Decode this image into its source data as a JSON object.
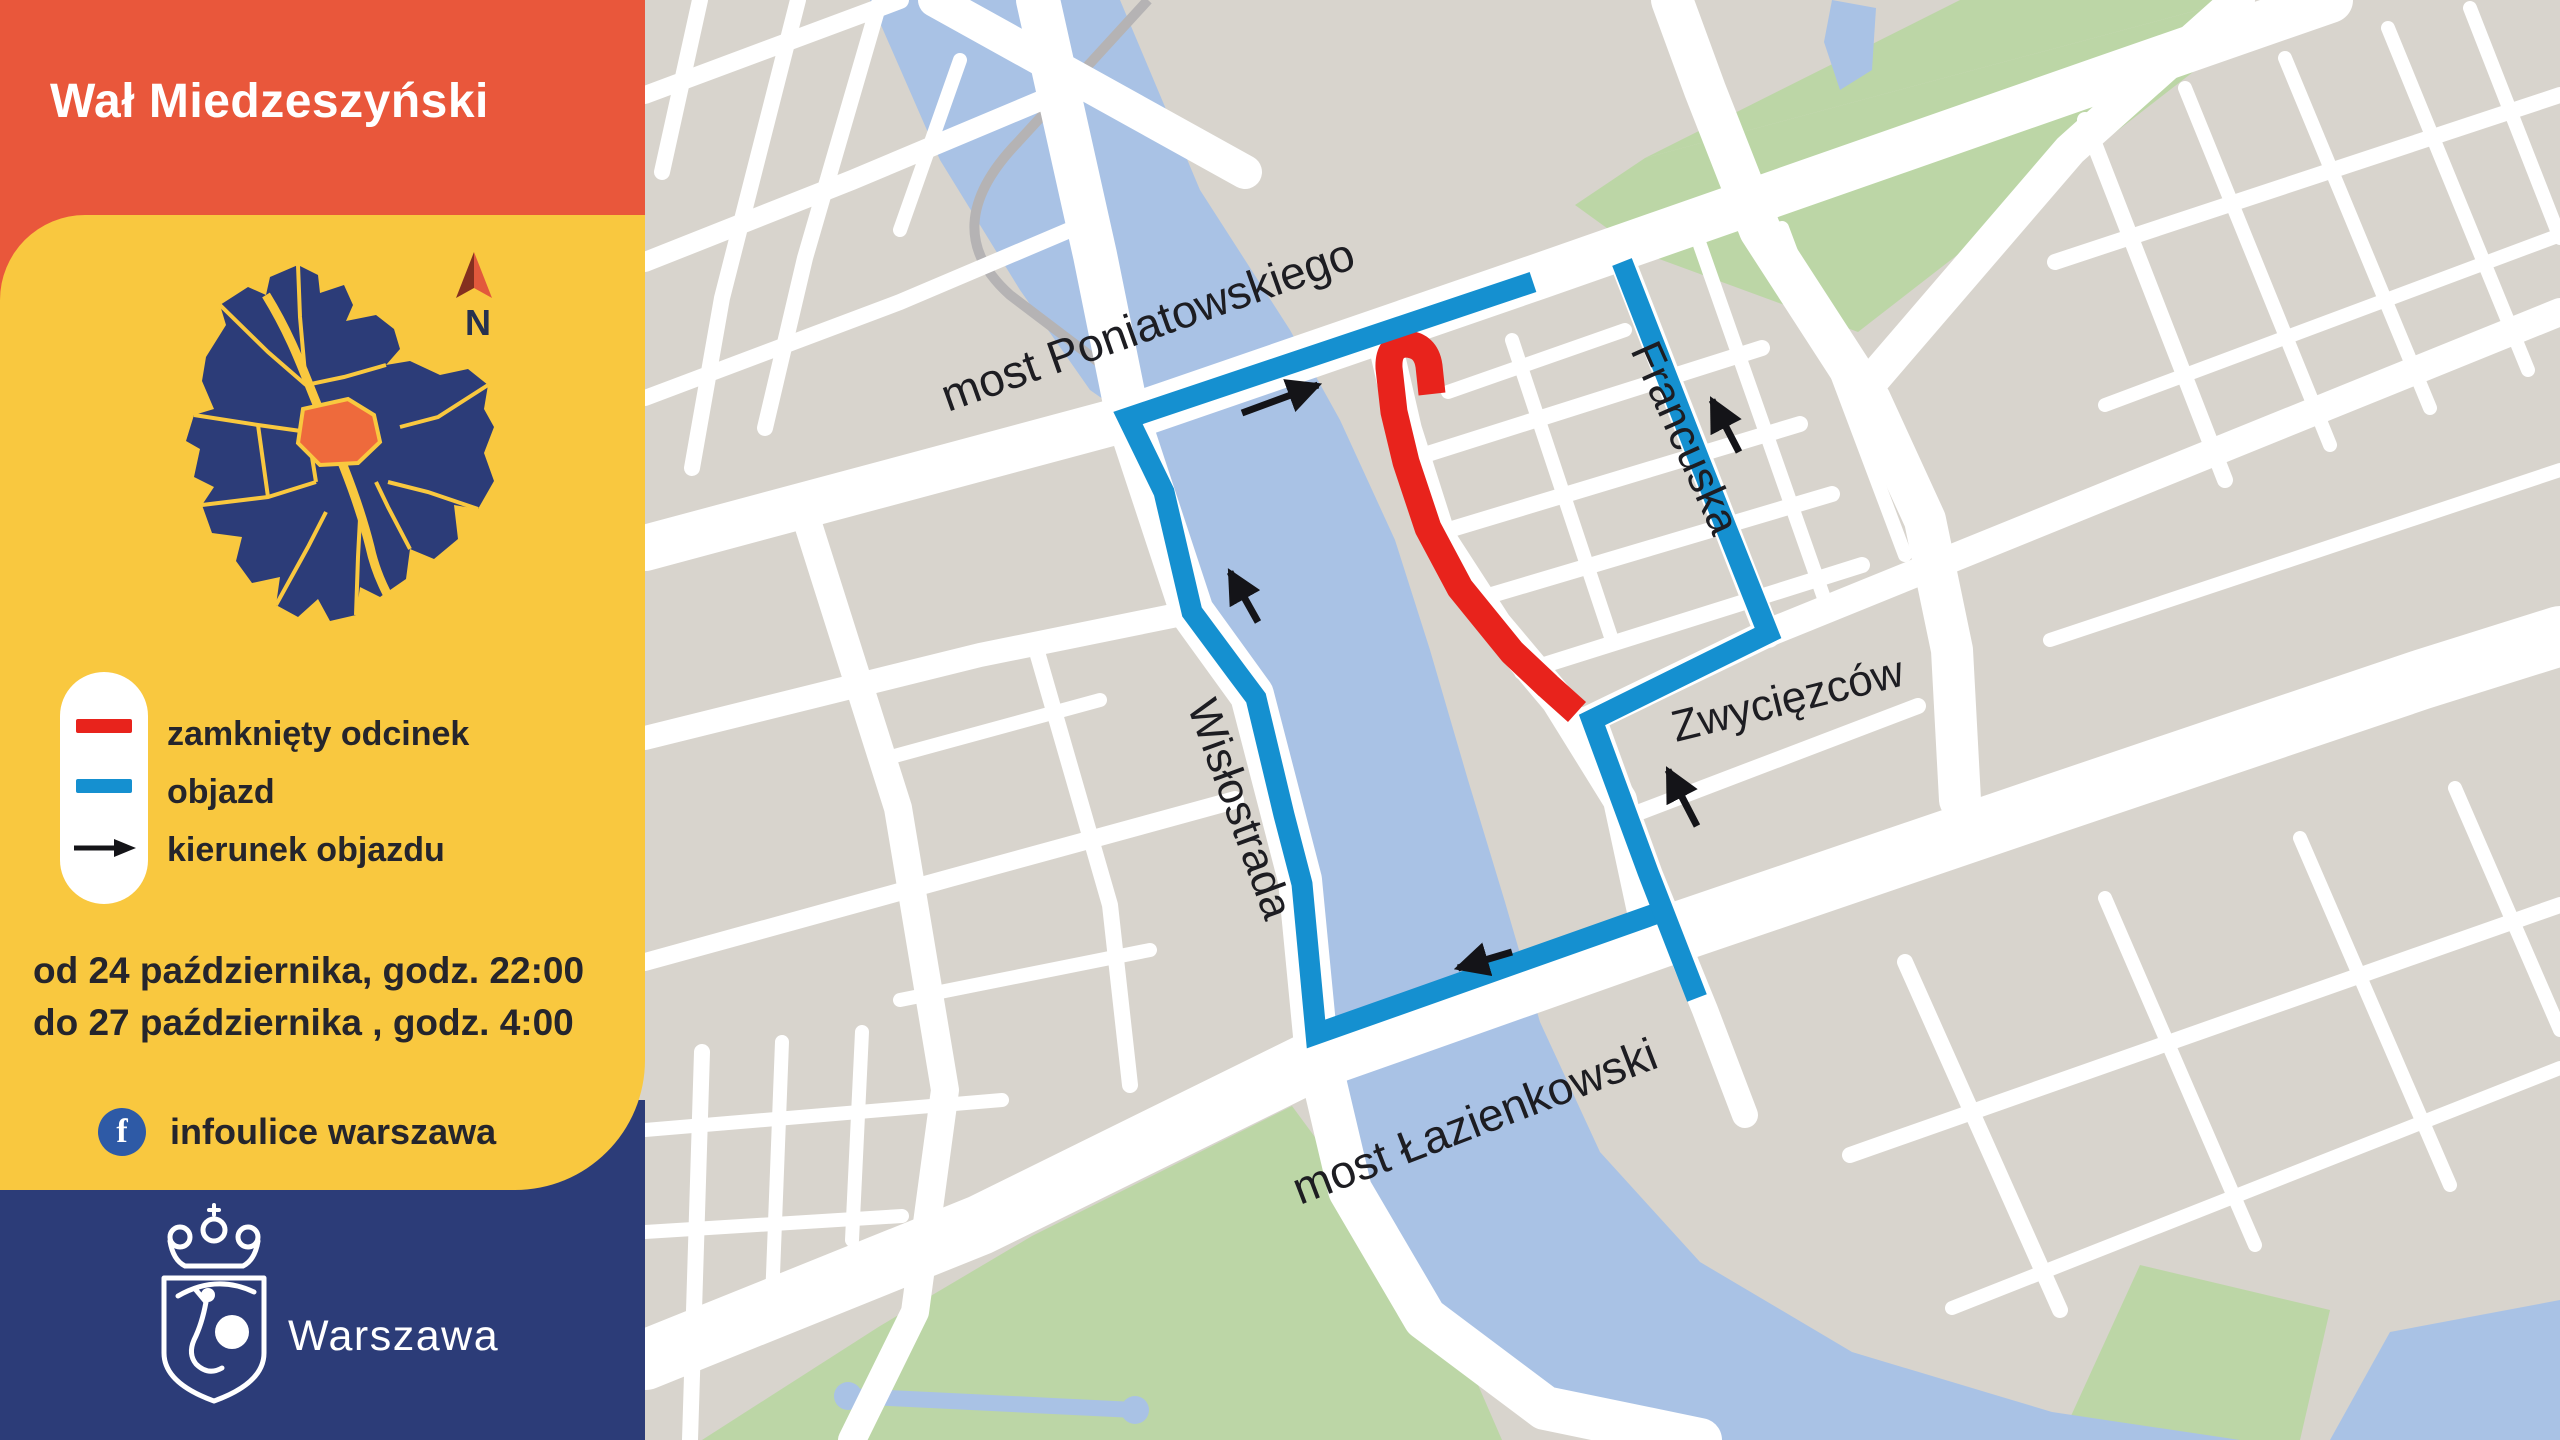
{
  "header": {
    "title": "Wał Miedzeszyński"
  },
  "minimap": {
    "compass_label": "N"
  },
  "legend": {
    "items": [
      {
        "id": "closed-section",
        "label": "zamknięty odcinek",
        "color": "#E8231C"
      },
      {
        "id": "detour",
        "label": "objazd",
        "color": "#1590D0"
      },
      {
        "id": "detour-direction",
        "label": "kierunek objazdu",
        "color": "#1A1A1F"
      }
    ]
  },
  "schedule": {
    "line1": "od 24 października, godz. 22:00",
    "line2": "do 27 października , godz. 4:00"
  },
  "social": {
    "network": "Facebook",
    "label": "infoulice warszawa"
  },
  "footer": {
    "city": "Warszawa"
  },
  "map": {
    "street_labels": [
      {
        "id": "most-poniatowskiego",
        "text": "most Poniatowskiego"
      },
      {
        "id": "francuska",
        "text": "Francuska"
      },
      {
        "id": "zwyciezcow",
        "text": "Zwycięzców"
      },
      {
        "id": "wislostrada",
        "text": "Wisłostrada"
      },
      {
        "id": "most-lazienkowski",
        "text": "most Łazienkowski"
      }
    ],
    "route_colors": {
      "closed": "#E8231C",
      "detour": "#1590D0"
    }
  },
  "palette": {
    "header_orange": "#E9573B",
    "panel_yellow": "#F9C83F",
    "navy": "#2C3C78",
    "map_land": "#D8D4CD",
    "map_water": "#A9C2E5",
    "map_green": "#BCD6A6",
    "facebook_blue": "#2E5AA6"
  }
}
